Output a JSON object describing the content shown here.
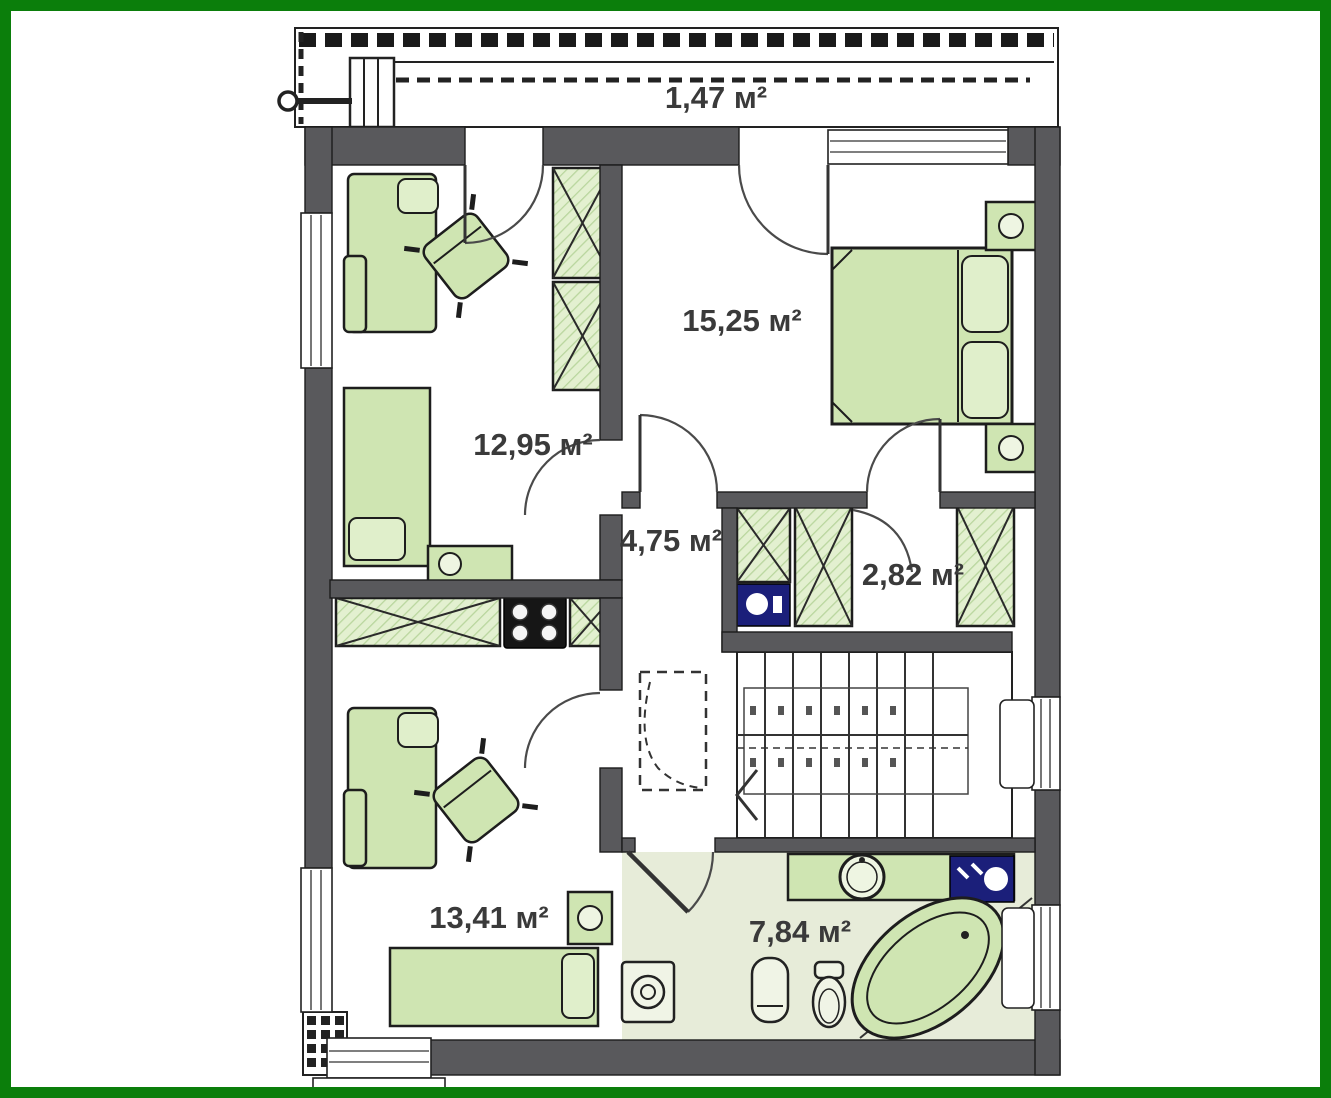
{
  "plan": {
    "kind": "apartment-floor-plan",
    "area_unit": "м²"
  },
  "rooms": [
    {
      "id": "balcony",
      "area_label": "1,47 м²"
    },
    {
      "id": "bedroom",
      "area_label": "15,25 м²"
    },
    {
      "id": "room-top-left",
      "area_label": "12,95 м²"
    },
    {
      "id": "hall",
      "area_label": "4,75 м²"
    },
    {
      "id": "wardrobe-closet",
      "area_label": "2,82 м²"
    },
    {
      "id": "room-bottom-left",
      "area_label": "13,41 м²"
    },
    {
      "id": "bathroom",
      "area_label": "7,84 м²"
    }
  ],
  "colors": {
    "frame_green": "#0b7e0b",
    "wall_gray": "#59595c",
    "furniture_green": "#cfe5b2",
    "hatch_green": "#e3f0d0",
    "bathroom_floor": "#e7ecd9",
    "appliance_navy": "#1b1f7a",
    "label_text": "#3a3a3a"
  }
}
